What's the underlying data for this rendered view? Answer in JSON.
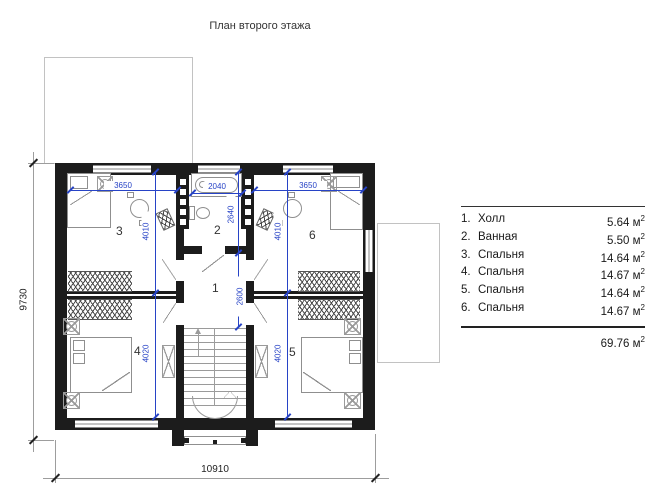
{
  "title": "План второго этажа",
  "legend": {
    "unit": "м",
    "sup": "2",
    "items": [
      {
        "num": "1.",
        "name": "Холл",
        "area": "5.64"
      },
      {
        "num": "2.",
        "name": "Ванная",
        "area": "5.50"
      },
      {
        "num": "3.",
        "name": "Спальня",
        "area": "14.64"
      },
      {
        "num": "4.",
        "name": "Спальня",
        "area": "14.67"
      },
      {
        "num": "5.",
        "name": "Спальня",
        "area": "14.64"
      },
      {
        "num": "6.",
        "name": "Спальня",
        "area": "14.67"
      }
    ],
    "total": "69.76"
  },
  "rooms": {
    "hall": "1",
    "bathroom": "2",
    "bedroom3": "3",
    "bedroom4": "4",
    "bedroom5": "5",
    "bedroom6": "6"
  },
  "dimensions": {
    "overall_width": "10910",
    "overall_height": "9730",
    "bedroom3_width": "3650",
    "bedroom3_height": "4010",
    "bedroom6_width": "3650",
    "bedroom6_height": "4010",
    "bathroom_width": "2040",
    "bathroom_height": "2640",
    "hall_height": "2600",
    "bedroom4_height": "4020",
    "bedroom5_height": "4020"
  }
}
